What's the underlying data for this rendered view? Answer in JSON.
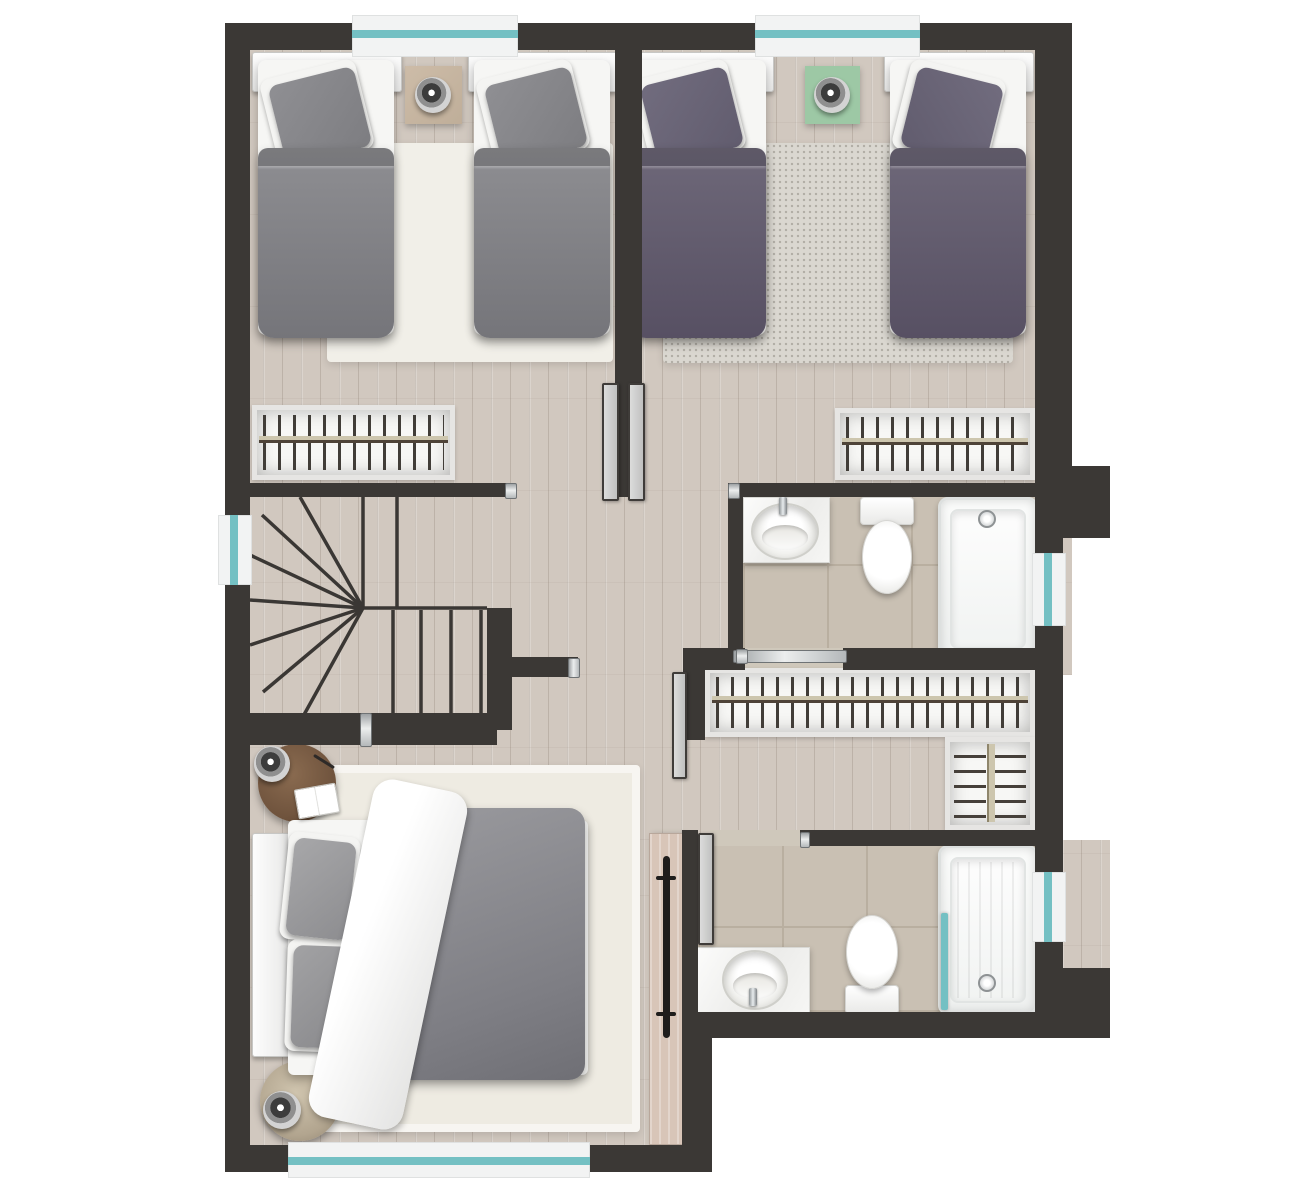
{
  "scene": {
    "kind": "residential floor plan, rendered top-down 3D view",
    "floor": "upper storey",
    "text_on_image": "none"
  },
  "theme": {
    "background": "#ffffff",
    "wall": "#3b3835",
    "wood_floor": "#d1c8bf",
    "wood_plank_line": "rgba(96,80,66,0.18)",
    "wood_highlight": "rgba(255,255,255,0.22)",
    "tile": "#c9c0b3",
    "tile_grout": "#b9afa0",
    "tile_light": "#cfc8bb",
    "rug_white": "#f1efe8",
    "rug_speckled": "#dad7d0",
    "rug_master": "#eeebe2",
    "duvet_gray_1": "#8e8e92",
    "duvet_gray_2": "#75757a",
    "duvet_purple_1": "#6e6879",
    "duvet_purple_2": "#575063",
    "pillow_gray": "#8f8f93",
    "pillow_purple": "#716c7e",
    "bed_white": "#f6f6f4",
    "accent_green": "#9dc8a5",
    "window_teal": "#74c0c3",
    "window_white": "#f2f3f3",
    "chrome": "#c6c9ca",
    "closet_white": "#f7f7f5",
    "rail_light": "#cdc6ae",
    "rail_dark": "#4e4338",
    "wood_table": "#6e523c",
    "marble_table": "#b2a58f",
    "door_wood": "#d8c5b8",
    "handle_black": "#1f1d1c"
  },
  "rooms": [
    {
      "id": "bedroom-left",
      "type": "twin bedroom",
      "furniture": [
        "twin bed with gray duvet",
        "twin bed with gray duvet",
        "wooden bedside mat",
        "round table lamp",
        "white shag rug",
        "built-in wardrobe with hangers"
      ],
      "windows": [
        "north"
      ]
    },
    {
      "id": "bedroom-right",
      "type": "twin bedroom",
      "furniture": [
        "twin bed with purple duvet",
        "twin bed with purple duvet",
        "green bedside mat",
        "round table lamp",
        "speckled gray rug",
        "built-in wardrobe with hangers"
      ],
      "windows": [
        "north"
      ]
    },
    {
      "id": "bathroom-top",
      "type": "bathroom",
      "fixtures": [
        "vanity counter with oval sink",
        "toilet",
        "bathtub"
      ],
      "doors": [
        "sliding chrome door"
      ],
      "windows": [
        "east"
      ]
    },
    {
      "id": "landing",
      "type": "hallway landing",
      "features": [
        "U-shaped winder staircase",
        "guard wall with chrome cap"
      ]
    },
    {
      "id": "walk-in-closet",
      "type": "closet corridor",
      "features": [
        "long hanging wardrobe",
        "linen shelving unit"
      ]
    },
    {
      "id": "master-bedroom",
      "type": "master bedroom",
      "furniture": [
        "double bed with gray duvet",
        "white draped sheet",
        "two stacked gray pillows",
        "round wood nightstand with lamp, book and pen",
        "round marble nightstand with lamp",
        "cream area rug",
        "sliding wood door with black pull"
      ],
      "windows": [
        "south"
      ]
    },
    {
      "id": "bathroom-bottom",
      "type": "bathroom / ensuite",
      "fixtures": [
        "vanity counter with round sink",
        "toilet",
        "walk-in shower tray",
        "teal glass screen"
      ],
      "doors": [
        "hinged door shown open"
      ],
      "windows": [
        "east"
      ]
    }
  ],
  "windows": [
    {
      "wall": "north",
      "room": "bedroom-left"
    },
    {
      "wall": "north",
      "room": "bedroom-right"
    },
    {
      "wall": "west",
      "room": "landing (stair)"
    },
    {
      "wall": "east",
      "room": "bathroom-top"
    },
    {
      "wall": "east",
      "room": "bathroom-bottom"
    },
    {
      "wall": "south",
      "room": "master-bedroom"
    }
  ],
  "stairs": {
    "type": "U-shaped with winders",
    "straight_treads": 6,
    "winder_treads": 7
  },
  "doors": [
    {
      "room": "bedroom-left",
      "state": "open, leaf parked on divider wall"
    },
    {
      "room": "bedroom-right",
      "state": "open, leaf parked on divider wall"
    },
    {
      "room": "bathroom-top",
      "state": "sliding, closed"
    },
    {
      "room": "walk-in-closet",
      "state": "open, leaf parked"
    },
    {
      "room": "bathroom-bottom",
      "state": "open, leaf parked"
    },
    {
      "room": "master-bedroom",
      "state": "sliding wood panel parked along wall"
    }
  ]
}
